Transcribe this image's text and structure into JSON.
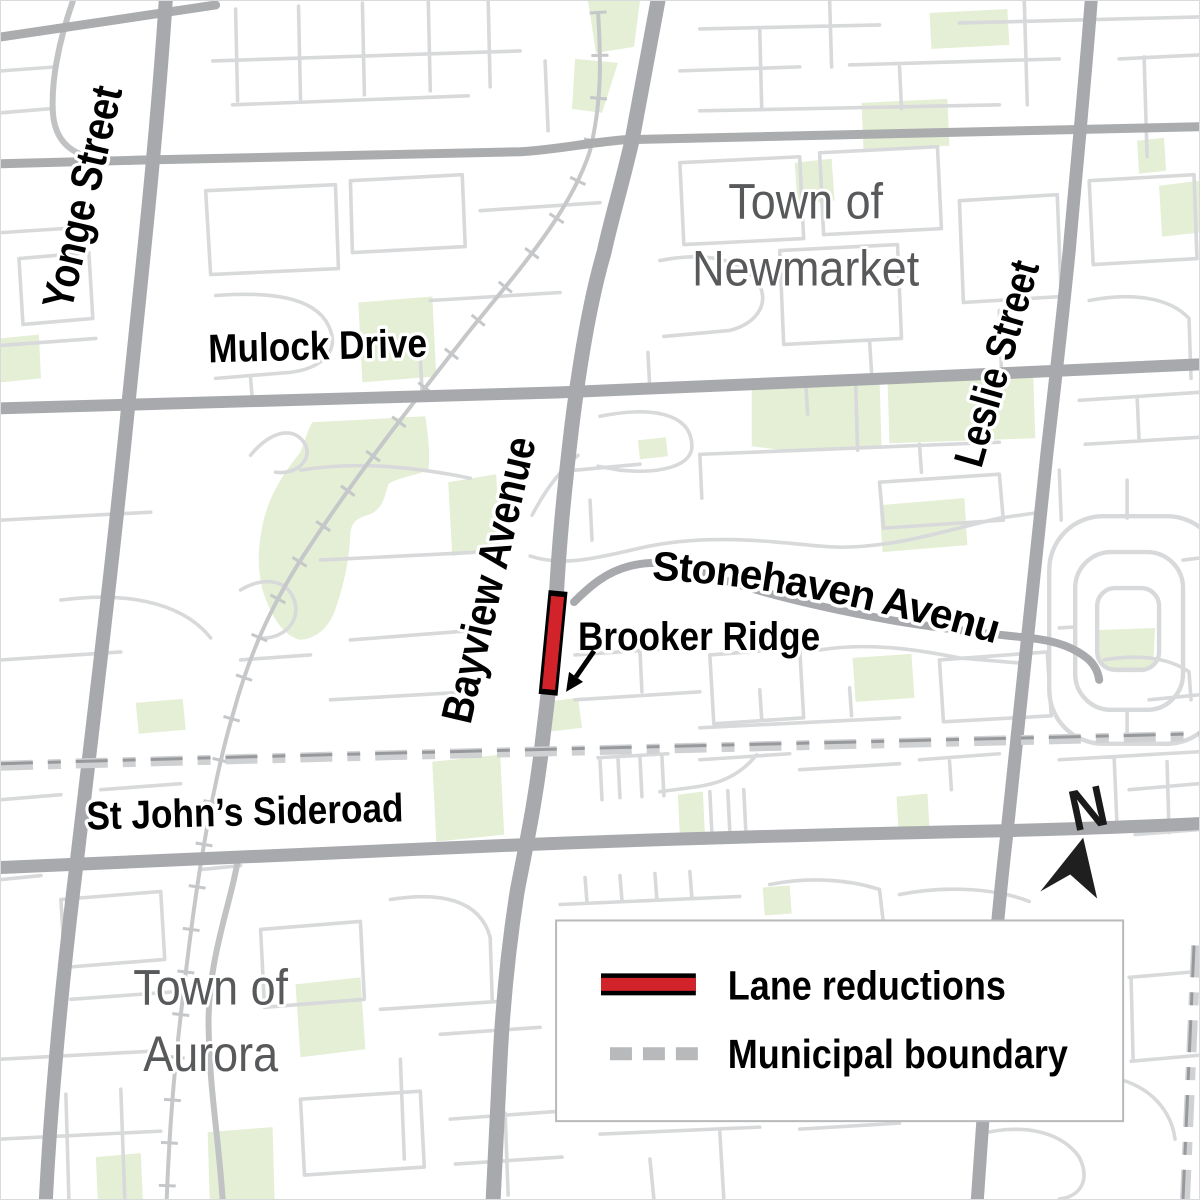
{
  "map": {
    "streets": {
      "yonge": "Yonge Street",
      "mulock": "Mulock Drive",
      "bayview": "Bayview Avenue",
      "stonehaven": "Stonehaven Avenue",
      "brooker_ridge": "Brooker Ridge",
      "st_johns": "St John’s Sideroad",
      "leslie": "Leslie Street"
    },
    "towns": {
      "newmarket_line1": "Town of",
      "newmarket_line2": "Newmarket",
      "aurora_line1": "Town of",
      "aurora_line2": "Aurora"
    },
    "north_label": "N",
    "colors": {
      "lane_reduction_red": "#d2232a",
      "municipal_boundary_gray": "#b7b9bb",
      "arterial_road_gray": "#a7a9ac",
      "minor_road_gray": "#d8d9da",
      "green_space": "#e4efd5",
      "town_label_gray": "#58595b"
    }
  },
  "legend": {
    "items": [
      {
        "label": "Lane reductions",
        "symbol": "red-line-black-casing"
      },
      {
        "label": "Municipal boundary",
        "symbol": "gray-dashes"
      }
    ]
  }
}
